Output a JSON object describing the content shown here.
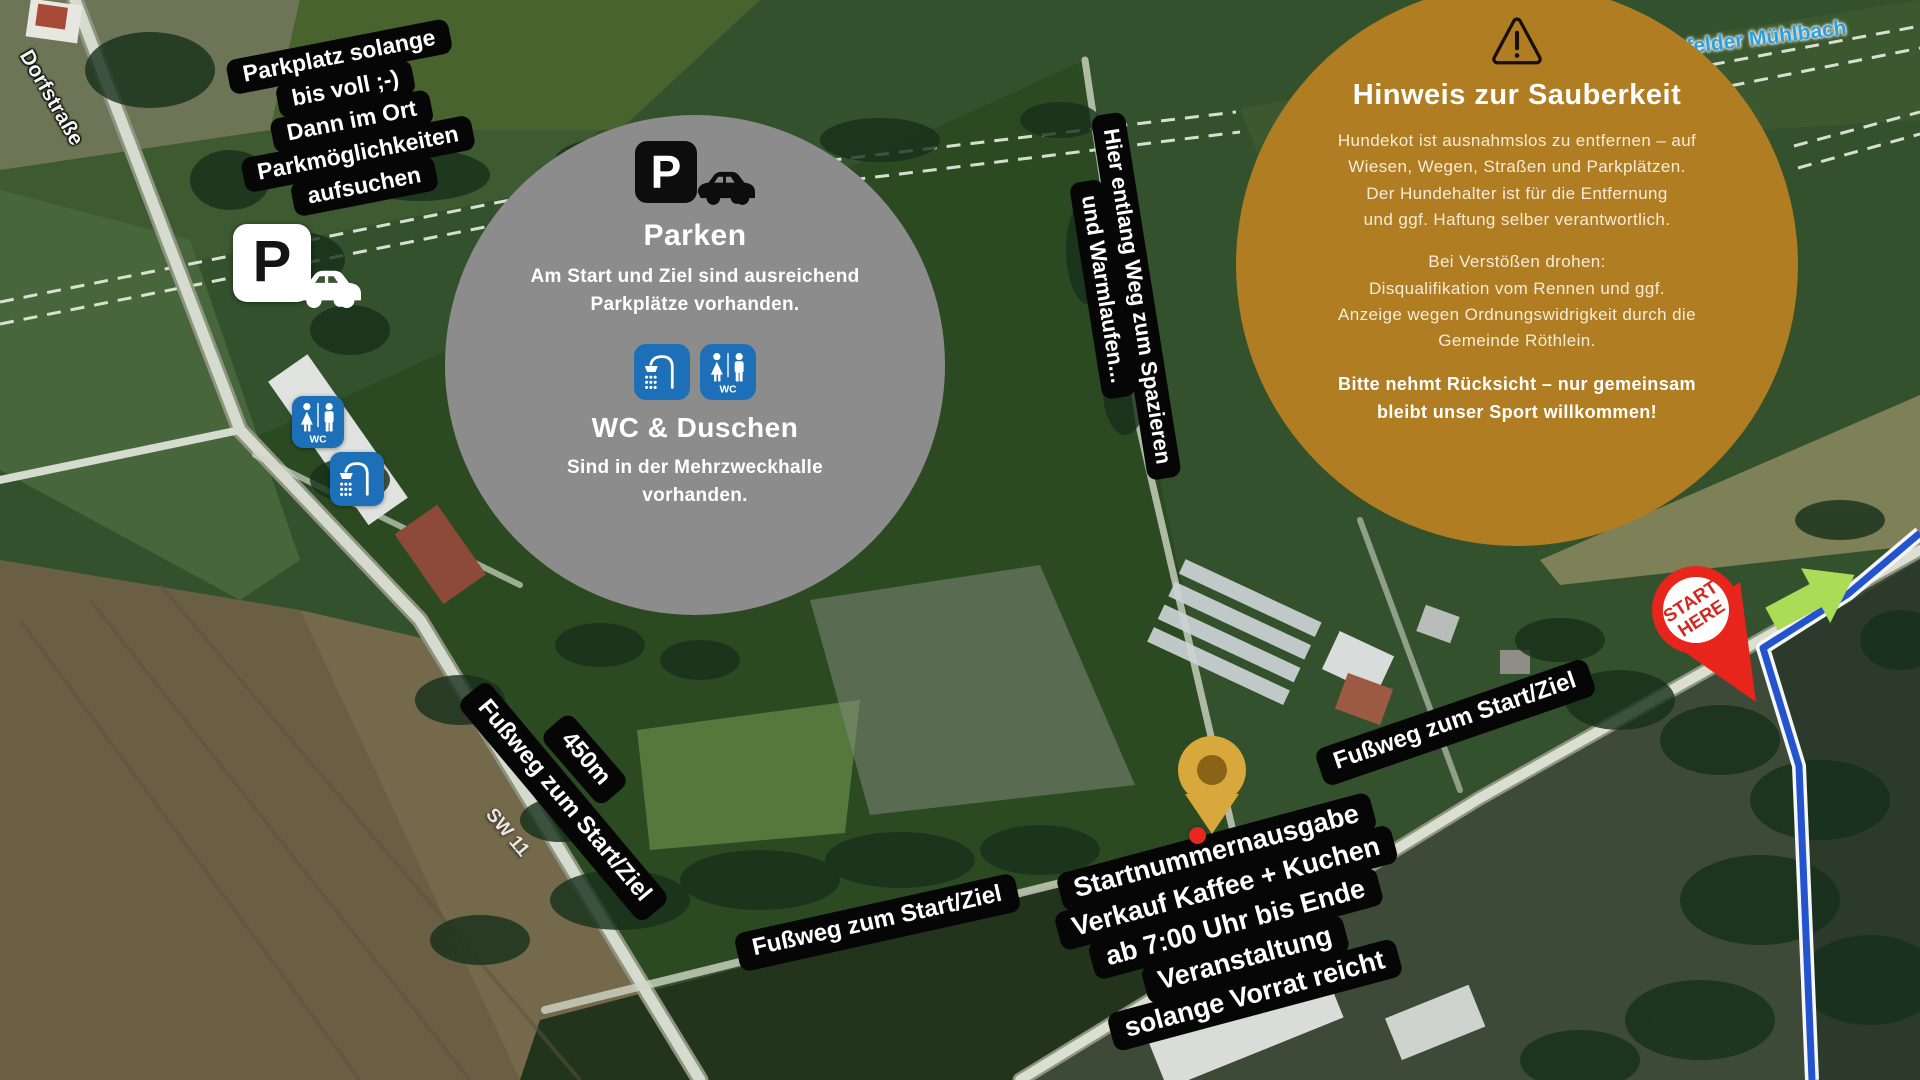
{
  "colors": {
    "label_bg": "#060606",
    "info_circle_bg": "#8c8c8c",
    "hinweis_circle_bg": "#b07d22",
    "icon_blue": "#1d70b8",
    "route_blue": "#2353cf",
    "start_red": "#e8251c",
    "arrow_green": "#abdc57",
    "pin_gold": "#d9a83d"
  },
  "map_labels": {
    "street": "Dorfstraße",
    "road": "SW 11",
    "stream": "felder Mühlbach"
  },
  "parking_note": {
    "lines": [
      "Parkplatz solange",
      "bis voll ;-)",
      "Dann im Ort",
      "Parkmöglichkeiten",
      "aufsuchen"
    ]
  },
  "map_icons": {
    "p_letter": "P",
    "wc_label": "WC"
  },
  "info_circle": {
    "p_letter": "P",
    "parken_title": "Parken",
    "parken_lines": [
      "Am Start und Ziel sind ausreichend",
      "Parkplätze vorhanden."
    ],
    "wc_title": "WC & Duschen",
    "wc_lines": [
      "Sind in der Mehrzweckhalle",
      "vorhanden."
    ],
    "wc_label": "WC"
  },
  "walk_label": {
    "lines": [
      "Hier entlang Weg zum Spazieren",
      "und Warmlaufen..."
    ]
  },
  "footpath": {
    "left": "Fußweg zum Start/Ziel",
    "bottom": "Fußweg zum Start/Ziel",
    "right": "Fußweg zum Start/Ziel",
    "distance": "450m"
  },
  "registration_label": {
    "lines": [
      "Startnummernausgabe",
      "Verkauf Kaffee + Kuchen",
      "ab 7:00 Uhr bis Ende",
      "Veranstaltung",
      "solange Vorrat reicht"
    ]
  },
  "hinweis_circle": {
    "title": "Hinweis zur Sauberkeit",
    "para1": [
      "Hundekot ist ausnahmslos zu entfernen – auf",
      "Wiesen, Wegen, Straßen und Parkplätzen.",
      "Der Hundehalter ist für die Entfernung",
      "und ggf. Haftung selber verantwortlich."
    ],
    "para2": [
      "Bei Verstößen drohen:",
      "Disqualifikation vom Rennen und ggf.",
      "Anzeige wegen Ordnungswidrigkeit durch die",
      "Gemeinde Röthlein."
    ],
    "para3": [
      "Bitte nehmt Rücksicht – nur gemeinsam",
      "bleibt unser Sport willkommen!"
    ]
  },
  "start_marker": {
    "line1": "START",
    "line2": "HERE"
  }
}
